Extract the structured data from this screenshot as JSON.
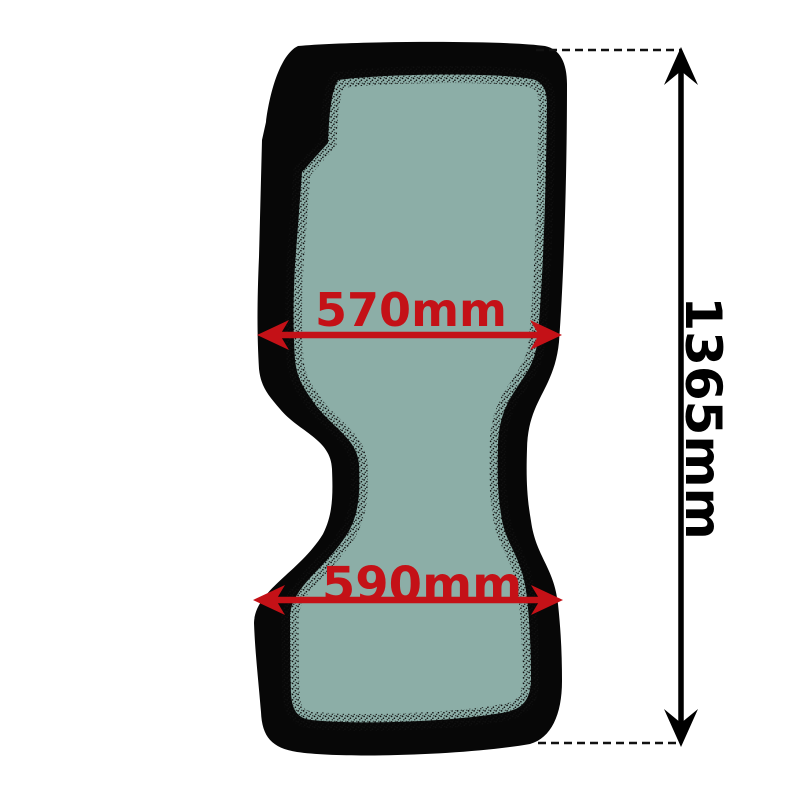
{
  "image": {
    "description": "vehicle-glass-dimension-diagram",
    "background_color": "#ffffff"
  },
  "glass_panel": {
    "seal_color": "#070707",
    "glass_color": "#8CAEA7",
    "frit_dot_color": "#101010"
  },
  "dimensions": {
    "accent_color": "#c41117",
    "dim_line_color": "#000000",
    "width_top": {
      "label": "570mm",
      "value": 570,
      "unit": "mm"
    },
    "width_bottom": {
      "label": "590mm",
      "value": 590,
      "unit": "mm"
    },
    "height": {
      "label": "1365mm",
      "value": 1365,
      "unit": "mm"
    }
  }
}
